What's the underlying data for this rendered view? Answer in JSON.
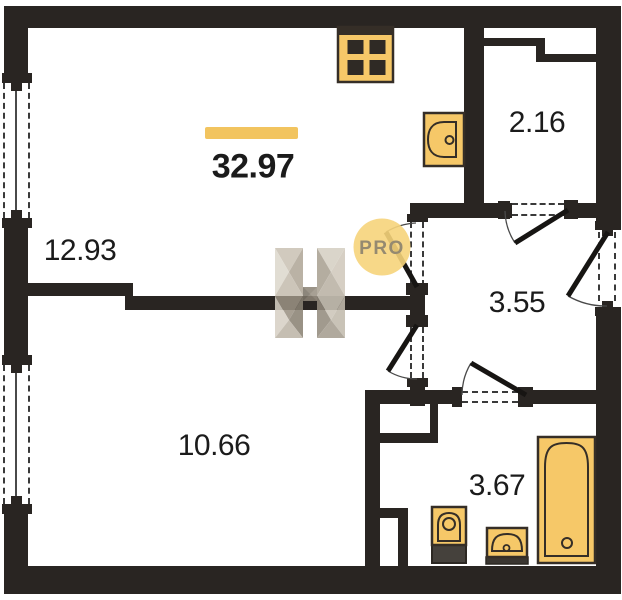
{
  "plan": {
    "total_area": "32.97",
    "rooms": {
      "living_kitchen": {
        "area": "12.93"
      },
      "bedroom": {
        "area": "10.66"
      },
      "hallway": {
        "area": "3.55"
      },
      "storage": {
        "area": "2.16"
      },
      "bathroom": {
        "area": "3.67"
      }
    },
    "watermark": {
      "badge": "PRO"
    },
    "fixtures": [
      "stove-icon",
      "kitchen-sink-icon",
      "toilet-icon",
      "washbasin-icon",
      "bathtub-icon"
    ],
    "counts": {
      "windows": 2,
      "doors": 5
    },
    "colors": {
      "wall": "#292522",
      "fixture_fill": "#f6c868",
      "fixture_stroke": "#352e27",
      "accent_bar": "#f2c45f",
      "watermark_circle": "#f6d47b",
      "watermark_text": "#958a70",
      "label_text": "#1b1b1b"
    }
  }
}
